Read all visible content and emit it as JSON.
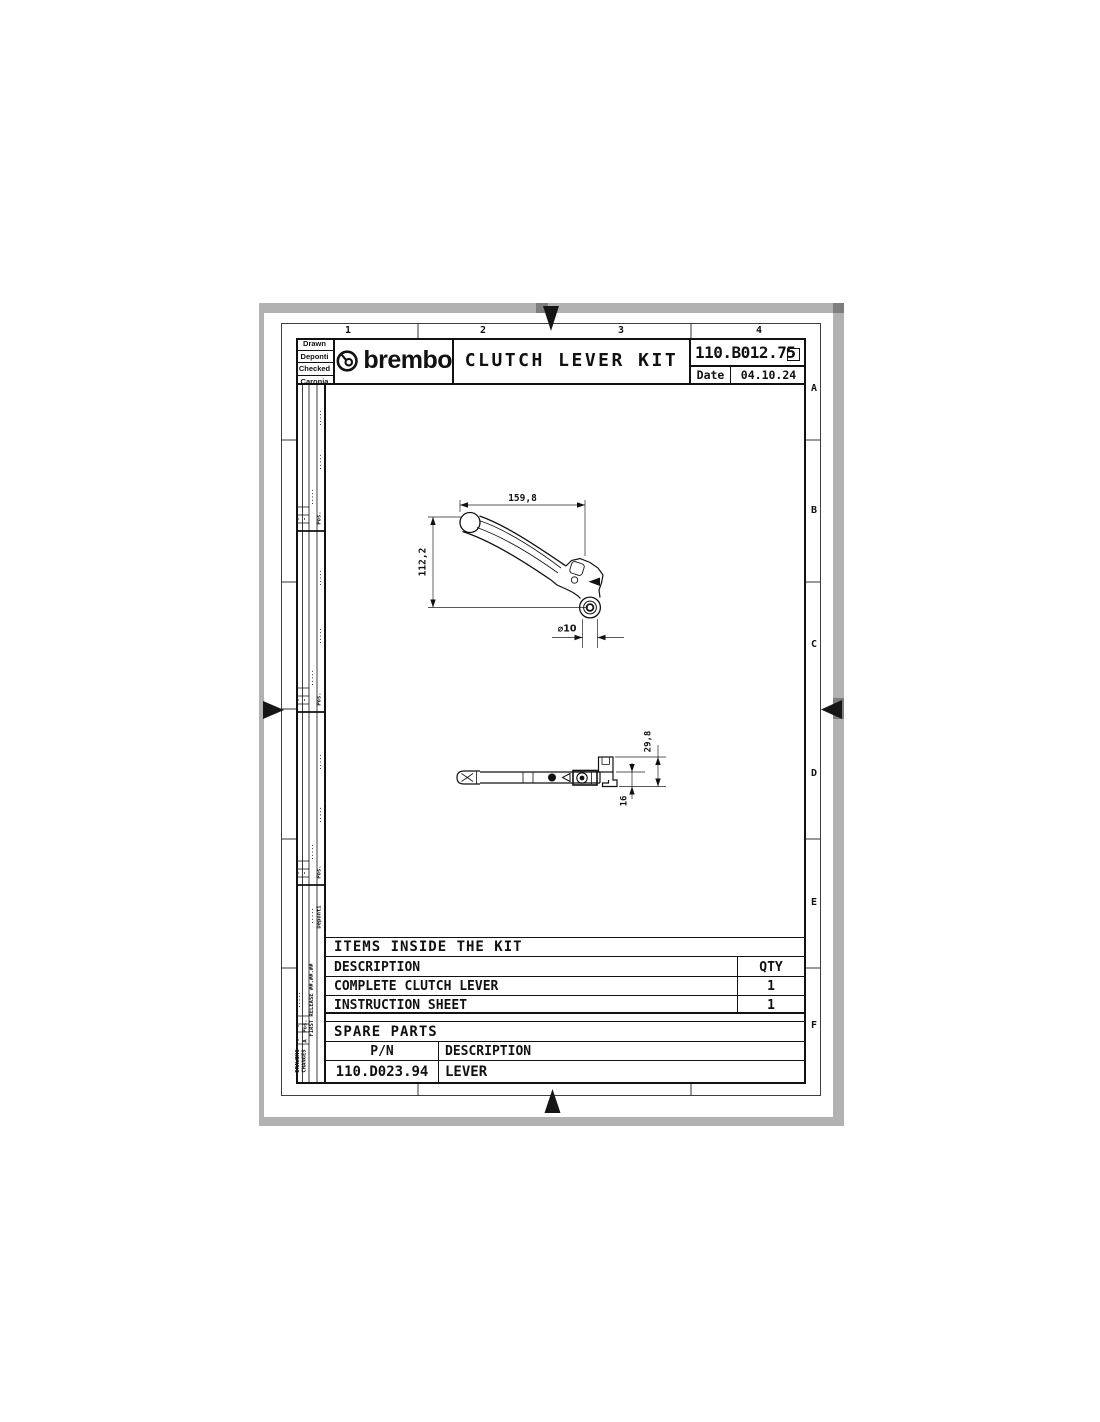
{
  "sheet": {
    "zone_columns": [
      "1",
      "2",
      "3",
      "4"
    ],
    "zone_rows": [
      "A",
      "B",
      "C",
      "D",
      "E",
      "F"
    ]
  },
  "title_block": {
    "signers": [
      "Drawn",
      "Deponti",
      "Checked",
      "Caronia"
    ],
    "brand": "brembo",
    "title": "CLUTCH LEVER KIT",
    "part_number": "110.B012.75",
    "revision": "-",
    "date_label": "Date",
    "date_value": "04.10.24"
  },
  "revision_strip": {
    "pos_label": "Pos.",
    "dots": ".....",
    "dash": "-",
    "rev_letter": "A",
    "author": "Deponti",
    "release_note": "FIRST RELEASE ##.##.##",
    "table_label_line1": "DRAWING",
    "table_label_line2": "CHANGES"
  },
  "drawing": {
    "front_view": {
      "dim_width": "159,8",
      "dim_height": "112,2",
      "dim_hole": "⌀10"
    },
    "side_view": {
      "dim_total_height": "29,8",
      "dim_thickness": "16"
    }
  },
  "kit_table": {
    "title": "ITEMS INSIDE THE KIT",
    "col_description": "DESCRIPTION",
    "col_qty": "QTY",
    "rows": [
      {
        "description": "COMPLETE CLUTCH LEVER",
        "qty": "1"
      },
      {
        "description": "INSTRUCTION SHEET",
        "qty": "1"
      }
    ]
  },
  "spare_table": {
    "title": "SPARE PARTS",
    "col_pn": "P/N",
    "col_description": "DESCRIPTION",
    "rows": [
      {
        "pn": "110.D023.94",
        "description": "LEVER"
      }
    ]
  }
}
